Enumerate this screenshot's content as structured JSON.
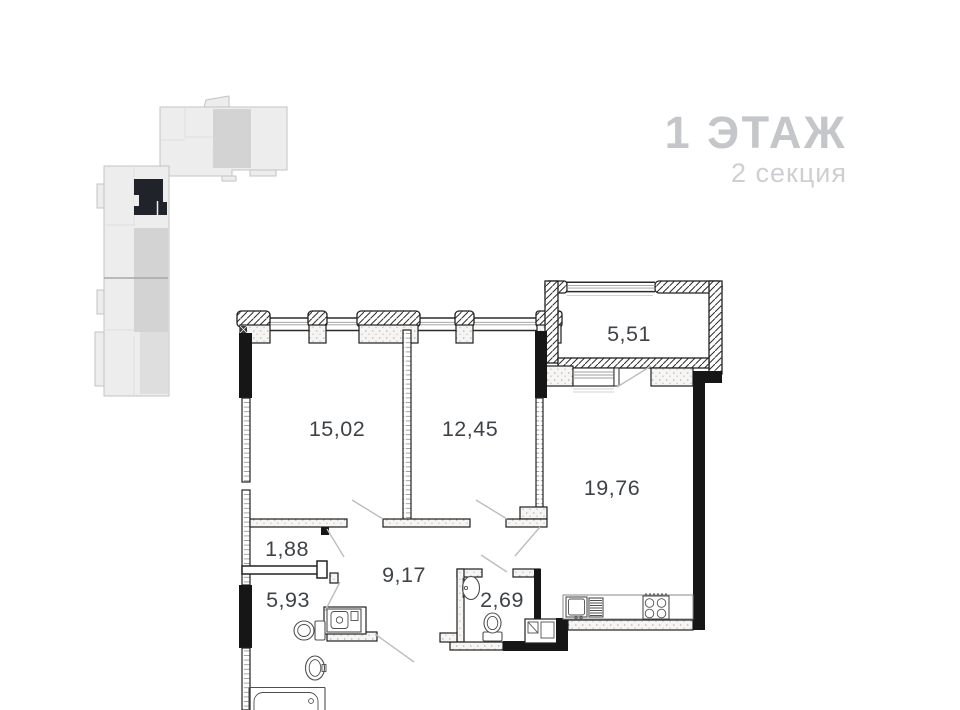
{
  "header": {
    "title": "1 ЭТАЖ",
    "subtitle": "2 секция"
  },
  "plan": {
    "room_areas": [
      "15,02",
      "12,45",
      "5,51",
      "19,76",
      "1,88",
      "9,17",
      "5,93",
      "2,69"
    ]
  },
  "colors": {
    "wall_black": "#161616",
    "title_gray": "#c4c6c9",
    "subtitle_gray": "#cdcfd2",
    "area_label": "#3e4347",
    "door_leaf_gray": "#bdbdbd",
    "minimap_gray": "#ededed",
    "minimap_highlight": "#20242a"
  }
}
